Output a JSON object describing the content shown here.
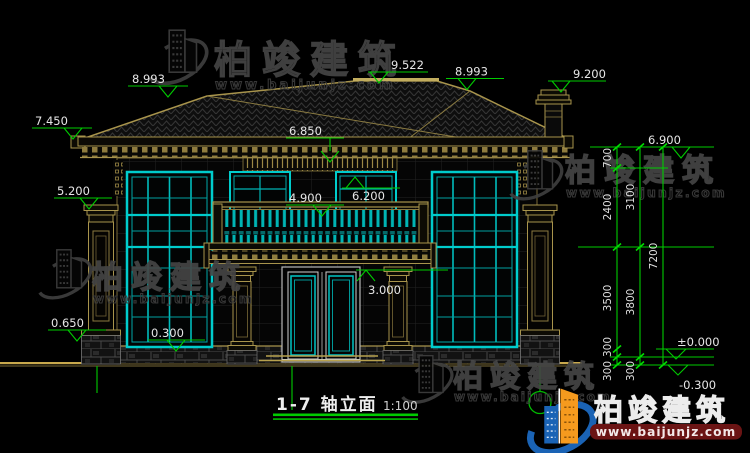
{
  "title": {
    "label": "1-7 轴立面",
    "scale": "1:100"
  },
  "brand": {
    "name": "柏竣建筑",
    "site": "www.baijunjz.com"
  },
  "levels": {
    "roof_left": "8.993",
    "ridge": "9.522",
    "roof_right": "8.993",
    "chimney_top": "9.200",
    "eave_left": "7.450",
    "cornice_mid": "6.850",
    "eave_right": "6.900",
    "pilaster_cap": "5.200",
    "window_top_mid": "6.200",
    "balcony_rail": "4.900",
    "canopy": "3.000",
    "base_left": "0.650",
    "sill": "0.300",
    "zero": "±0.000",
    "ground": "-0.300"
  },
  "chain": {
    "s700": "700",
    "s2400": "2400",
    "s3100": "3100",
    "s3500": "3500",
    "s3800": "3800",
    "s300": "300",
    "total": "7200"
  },
  "colors": {
    "line_tan": "#a8944c",
    "glass_cyan": "#00c9c9",
    "dim_green": "#00cc00",
    "text_white": "#e6e6e6",
    "logo_blue": "#1a63b5",
    "logo_orange": "#f59a1e",
    "logo_red_bar": "#6b1414"
  }
}
